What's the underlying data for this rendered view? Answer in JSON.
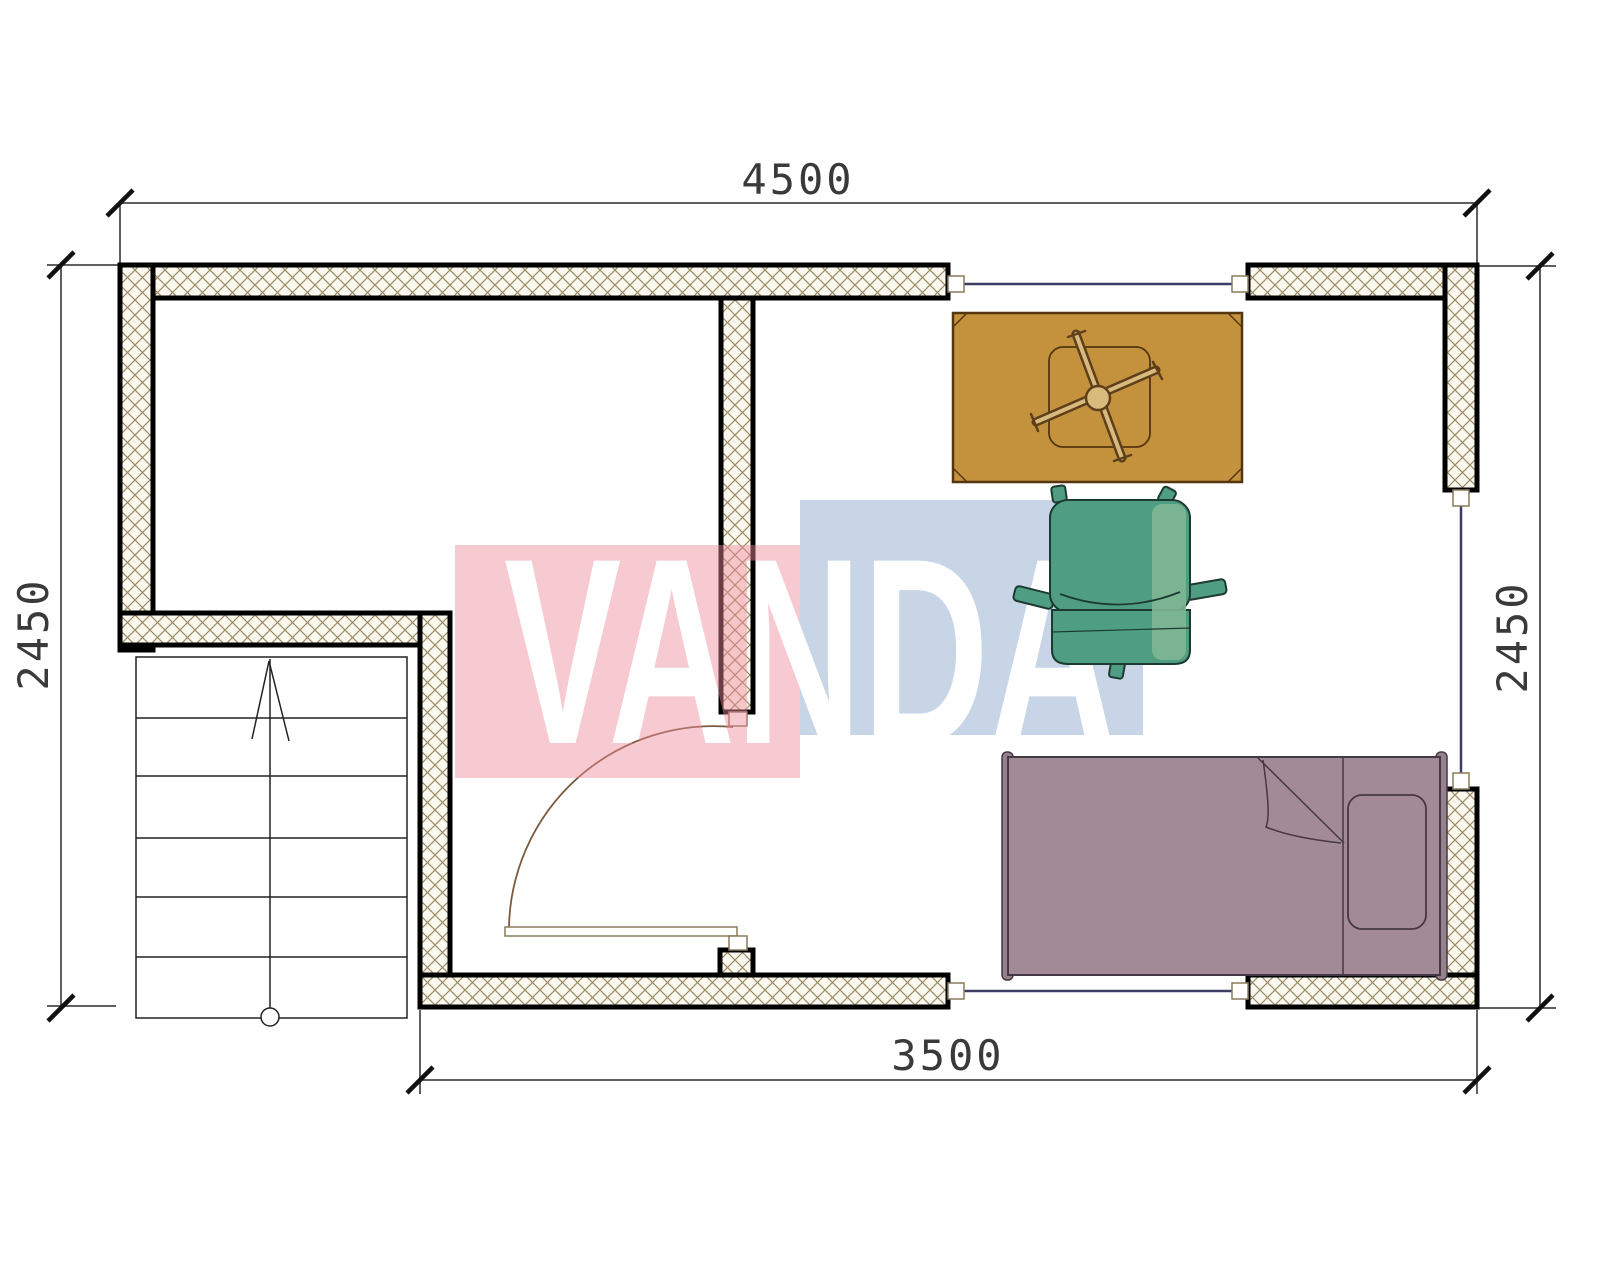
{
  "drawing": {
    "type": "floor-plan",
    "dimensions": {
      "top": "4500",
      "bottom": "3500",
      "left": "2450",
      "right": "2450"
    },
    "watermark": {
      "text": "VANDA",
      "red_block_color": "#ee8899",
      "blue_block_color": "#7a9cc6"
    },
    "colors": {
      "wall_hatch": "#9b8a66",
      "wall_fill": "#fbf8ef",
      "window_line": "#3c3c64",
      "door_arc": "#7b5b3f",
      "desk": "#c4923c",
      "desk_trim": "#54370f",
      "cross_light": "#d9ba7d",
      "cross_dark": "#5e3f1c",
      "chair": "#4f9e84",
      "chair_light": "#7fb694",
      "chair_outline": "#1c3a31",
      "bed": "#a28b97",
      "bed_post": "#95828e",
      "bed_outline": "#463844",
      "marker_outline": "#8a7a5a"
    }
  }
}
